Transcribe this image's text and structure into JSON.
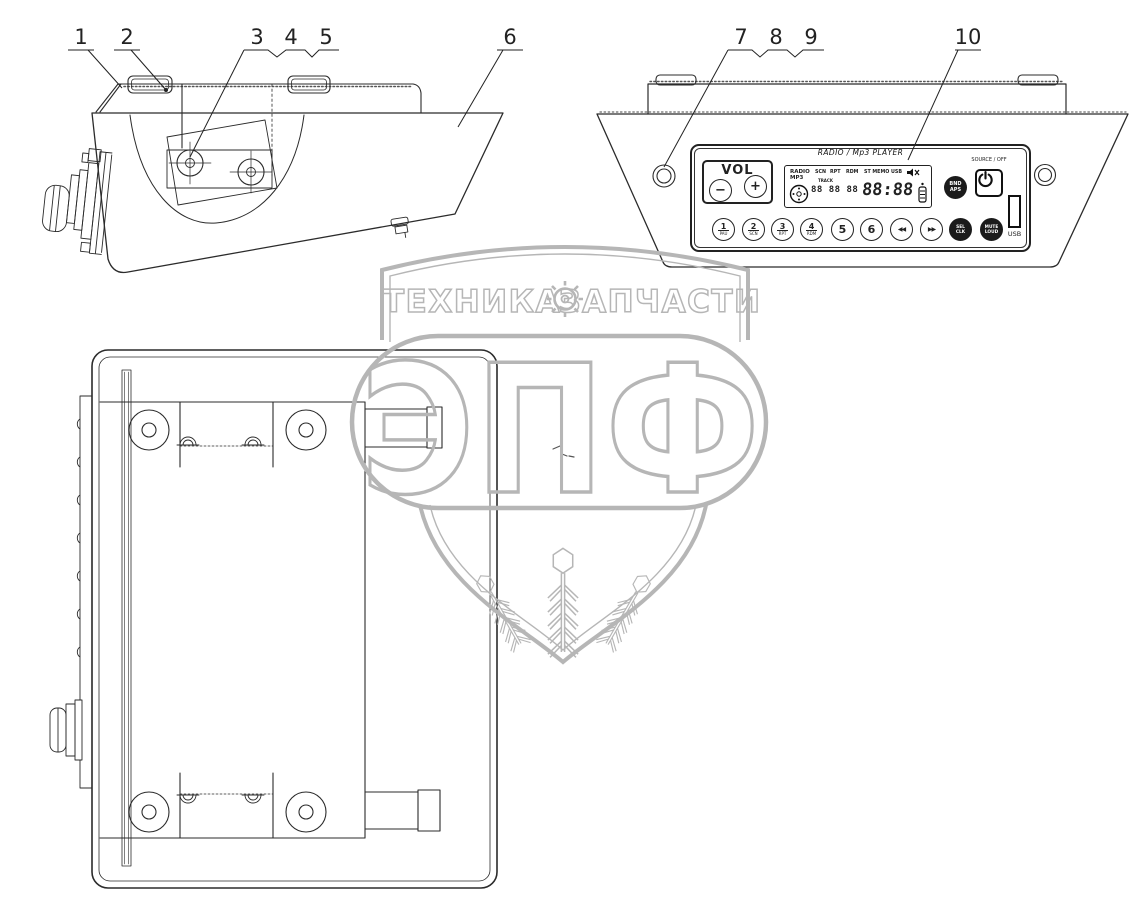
{
  "callouts": {
    "labels": [
      "1",
      "2",
      "3",
      "4",
      "5",
      "6",
      "7",
      "8",
      "9",
      "10"
    ]
  },
  "watermark": {
    "left_text": "ТЕХНИКА",
    "right_text": "ЗАПЧАСТИ",
    "brand": "ЭПФ"
  },
  "radio": {
    "title": "RADIO / Mp3 PLAYER",
    "vol": {
      "label": "VOL",
      "minus": "−",
      "plus": "+"
    },
    "display": {
      "mode_line1": "RADIO",
      "mode_line2": "MP3",
      "flag1": "SCN",
      "flag2": "RPT",
      "flag3": "RDM",
      "flag4": "ST MEMO",
      "flag5": "USB",
      "track_label": "TRACK",
      "small_digits": "88 88 88",
      "large_digits": "88:88"
    },
    "band_button": {
      "line1": "BND",
      "line2": "APS"
    },
    "source_label": "SOURCE / OFF",
    "usb_label": "USB",
    "buttons": [
      {
        "num": "1",
        "fn": "PAU"
      },
      {
        "num": "2",
        "fn": "SCN"
      },
      {
        "num": "3",
        "fn": "RPT"
      },
      {
        "num": "4",
        "fn": "RDM"
      },
      {
        "num": "5"
      },
      {
        "num": "6"
      },
      {
        "icon": "◀◀"
      },
      {
        "icon": "▶▶"
      },
      {
        "line1": "SEL",
        "line2": "CLK"
      },
      {
        "line1": "MUTE",
        "line2": "LOUD"
      }
    ]
  },
  "colors": {
    "line": "#2b2b2b",
    "watermark": "#b6b6b6"
  }
}
